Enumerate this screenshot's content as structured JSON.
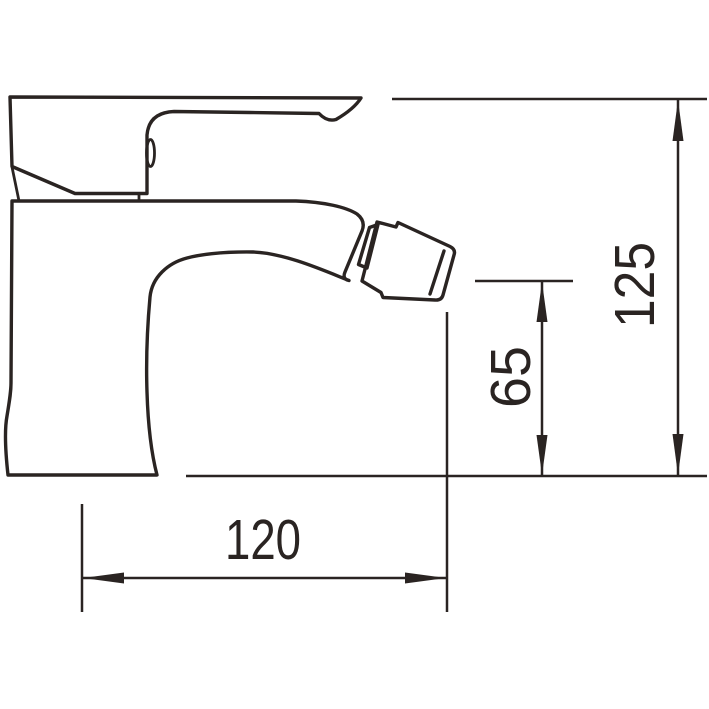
{
  "page": {
    "background_color": "#ffffff",
    "line_color": "#2a2422"
  },
  "drawing": {
    "kind": "technical-dimension-drawing",
    "subject": "single-lever bidet mixer faucet, side view",
    "units_implied": "mm",
    "dimensions": {
      "overall_height": {
        "value": "125",
        "orientation": "vertical"
      },
      "outlet_height": {
        "value": "65",
        "orientation": "vertical"
      },
      "spout_reach": {
        "value": "120",
        "orientation": "horizontal"
      }
    }
  }
}
